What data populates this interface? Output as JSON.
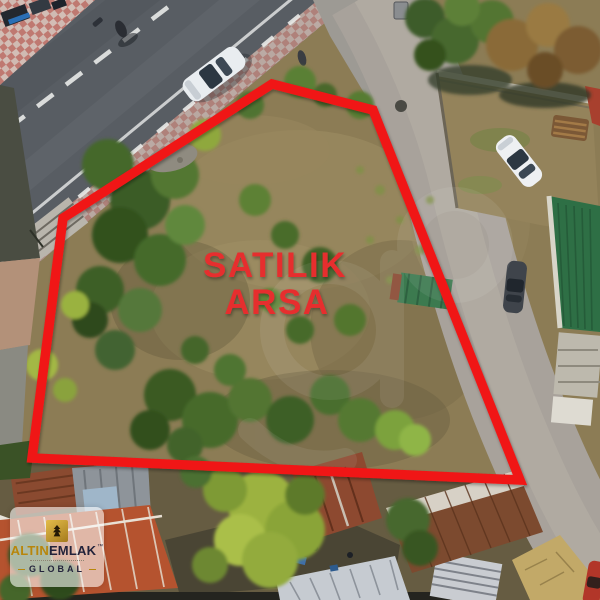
{
  "annotation": {
    "label_line1": "SATILIK",
    "label_line2": "ARSA",
    "label_color": "#e62e2e",
    "boundary_color": "#f01818"
  },
  "logo": {
    "brand_gold": "ALTIN",
    "brand_dark": "EMLAK",
    "trademark": "™",
    "sub_brand": "GLOBAL",
    "gold_color": "#b8860b",
    "dark_color": "#23233b"
  }
}
